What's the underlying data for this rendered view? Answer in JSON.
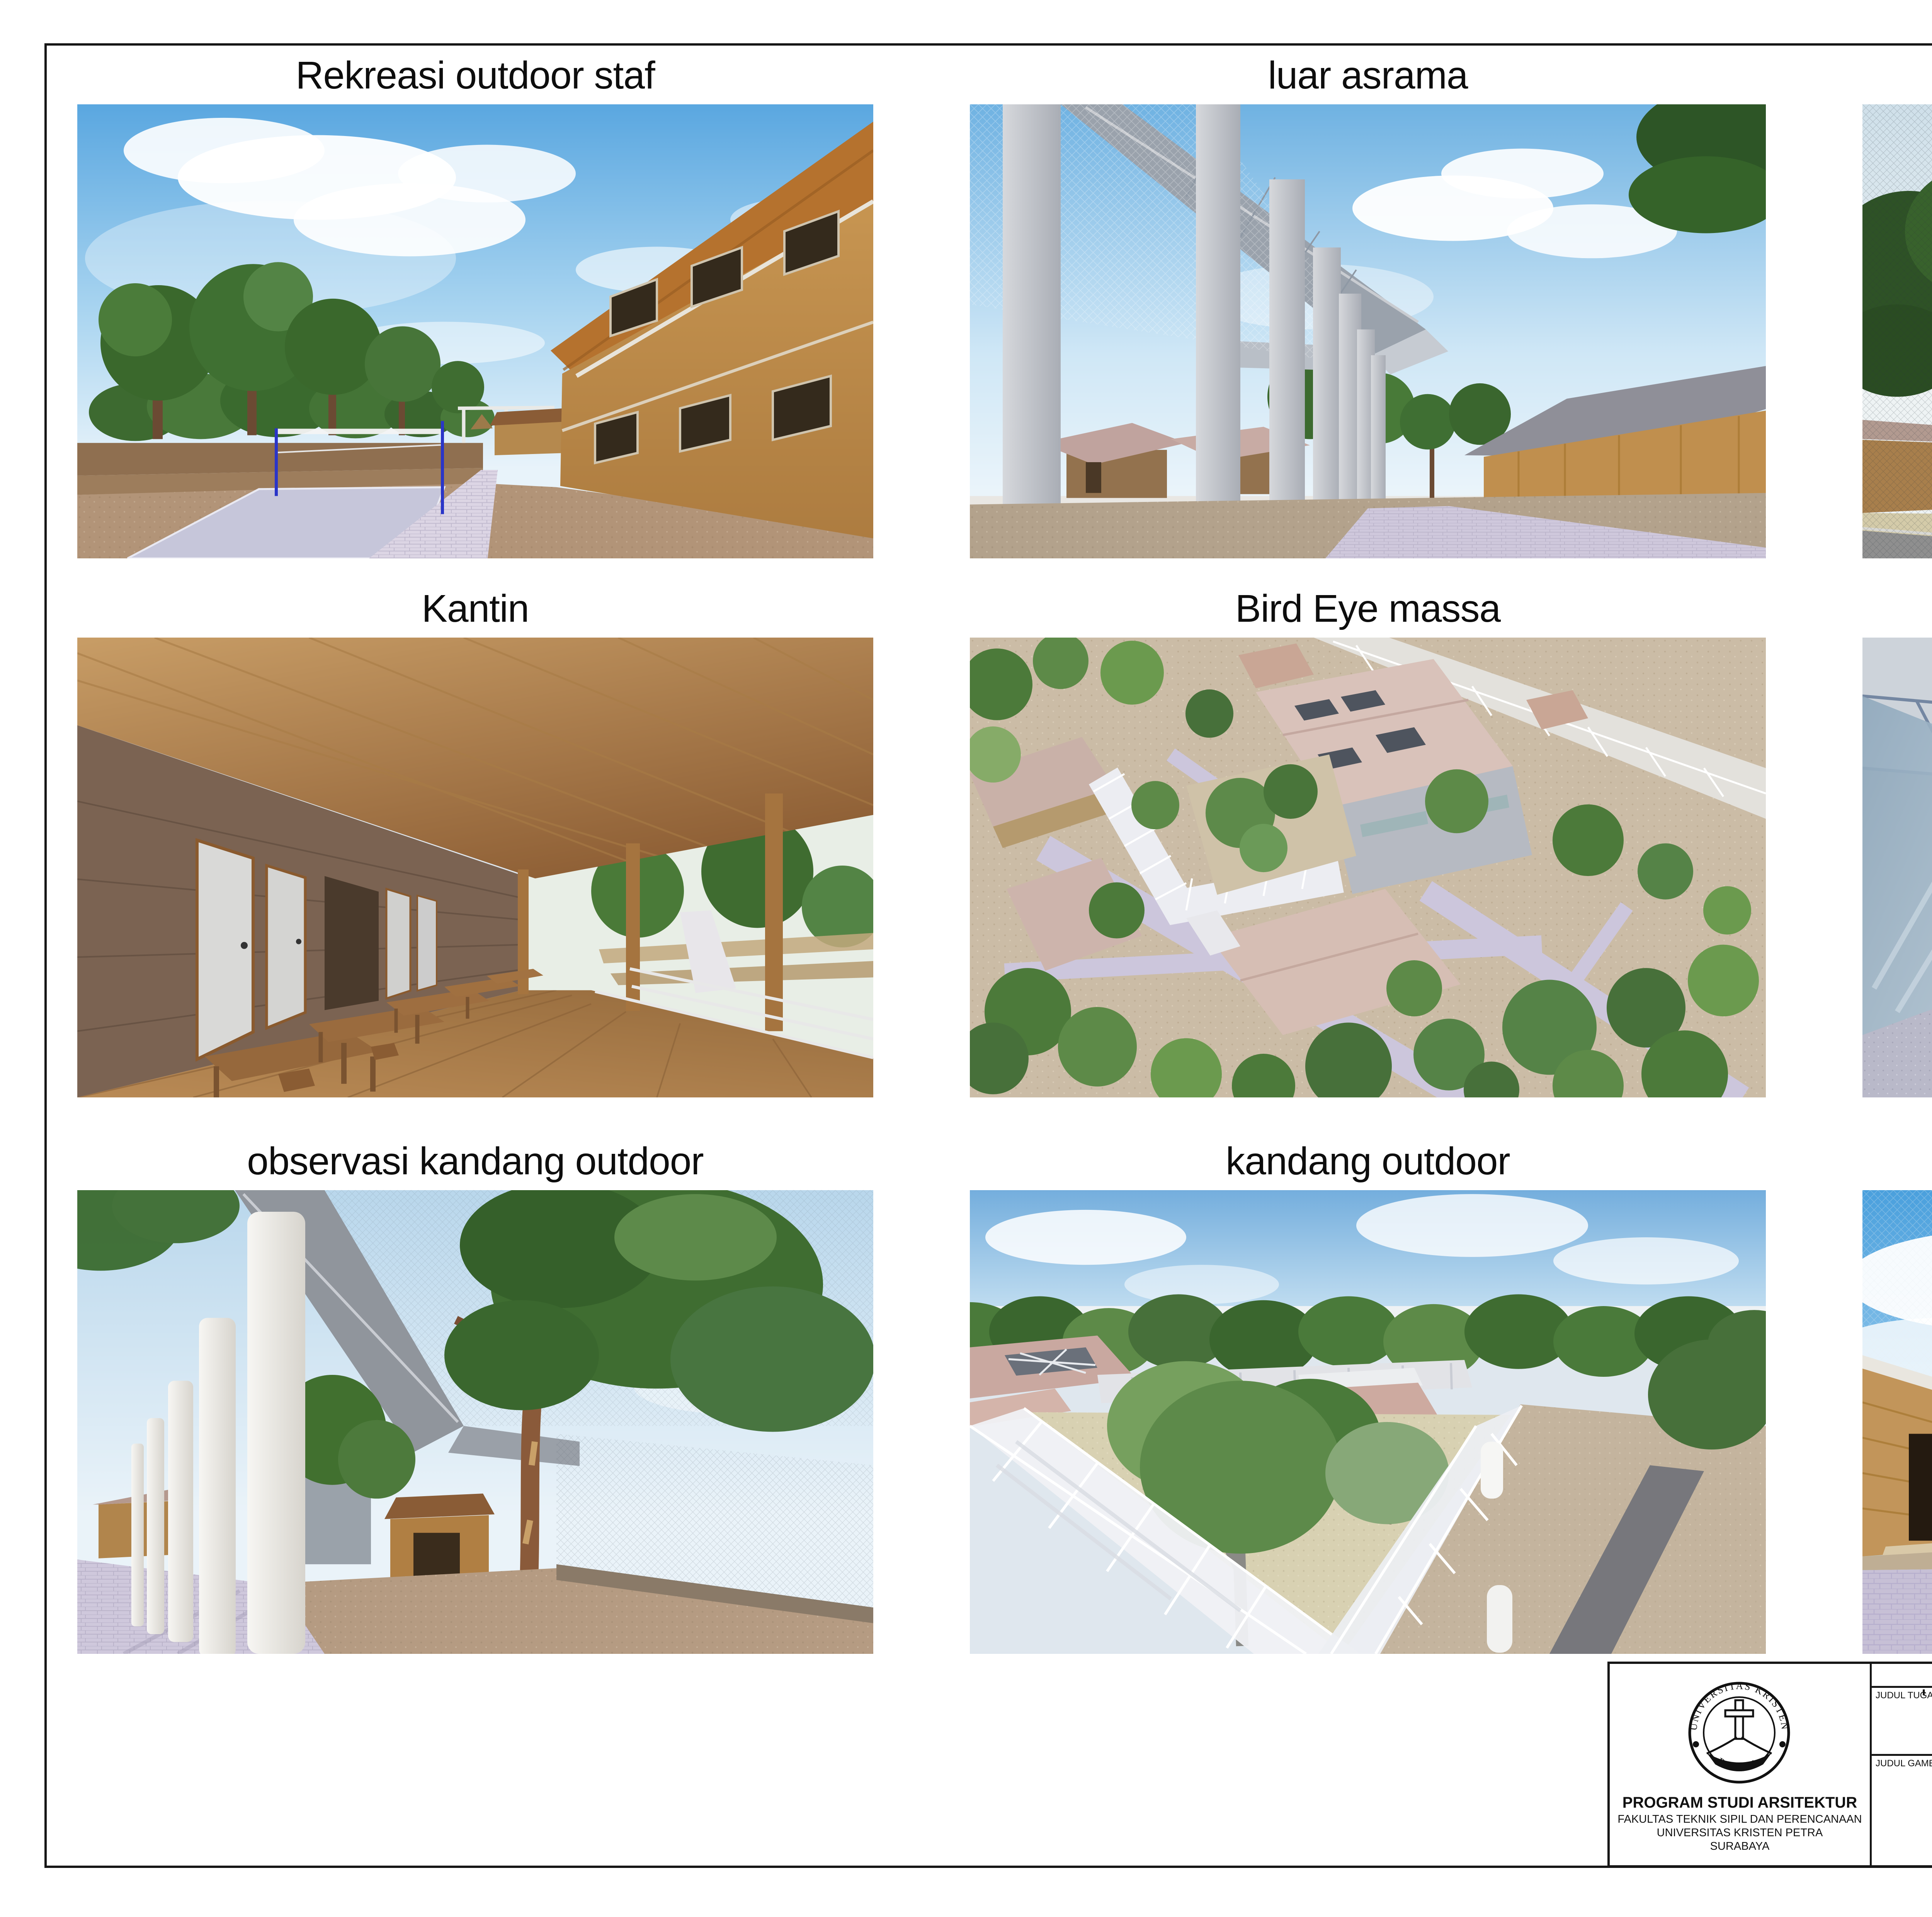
{
  "sheet": {
    "panels": [
      {
        "title": "Rekreasi outdoor staf"
      },
      {
        "title": "luar asrama"
      },
      {
        "title": "kandang outdoor"
      },
      {
        "title": "Kantin"
      },
      {
        "title": "Bird Eye massa"
      },
      {
        "title": "observasi kandang Indoor"
      },
      {
        "title": "observasi kandang outdoor"
      },
      {
        "title": "kandang outdoor"
      },
      {
        "title": "Entrance kandang dan satwa"
      }
    ]
  },
  "title_block": {
    "header": "TUGAS AKHIR - SEMESTER GANJIL 2022/2023",
    "judul_tugas": {
      "label": "JUDUL TUGAS",
      "line1": "Fasilitas Rehabilitasi Orangutan di Taman",
      "line2": "Nasional Tanjung Puting, Kalimantan Tengah"
    },
    "judul_gambar": {
      "label": "JUDUL GAMBAR",
      "value": "Perspektif"
    },
    "skala": {
      "label": "SKALA"
    },
    "nama": {
      "label": "NAMA",
      "value": "VIGILIO MANEK JUNIOR"
    },
    "nrp": {
      "label": "NRP",
      "value": "B12180120"
    },
    "kelompok": {
      "label": "KELOMPOK",
      "value": "2"
    },
    "mentor_utama": {
      "label": "MENTOR UTAMA",
      "value": "DR. IR. JOYCE MARCELLA LAURENS, M.Arch"
    },
    "mentor_pendamping": {
      "label": "MENTOR PENDAMPING",
      "value1": "IR. ANDHI WIJAYA, M.T.",
      "value2": "IR. IRWAN SANTOSO, MT."
    },
    "lembar": {
      "label": "LEMBAR"
    },
    "jumlah": {
      "label": "JUMLAH"
    },
    "institution": {
      "seal_text_top": "UNIVERSITAS KRISTEN",
      "seal_text_bottom": "PETRA",
      "line1": "PROGRAM STUDI ARSITEKTUR",
      "line2": "FAKULTAS TEKNIK SIPIL DAN PERENCANAAN",
      "line3": "UNIVERSITAS KRISTEN PETRA",
      "line4": "SURABAYA"
    }
  },
  "palette": {
    "sky_blue": "#5aa7e0",
    "sky_pale": "#e8f3fa",
    "tree_green": "#3f6d31",
    "wood": "#c6984f",
    "roof_shingle": "#b5722e",
    "roof_pink": "#d0b0a8",
    "paving_lavender": "#ccc5dc",
    "gravel_tan": "#b09679",
    "sand_pale": "#d4cba9",
    "structure_gray": "#9aa2ac",
    "net_post_blue": "#2a35c8",
    "line_black": "#161616"
  }
}
